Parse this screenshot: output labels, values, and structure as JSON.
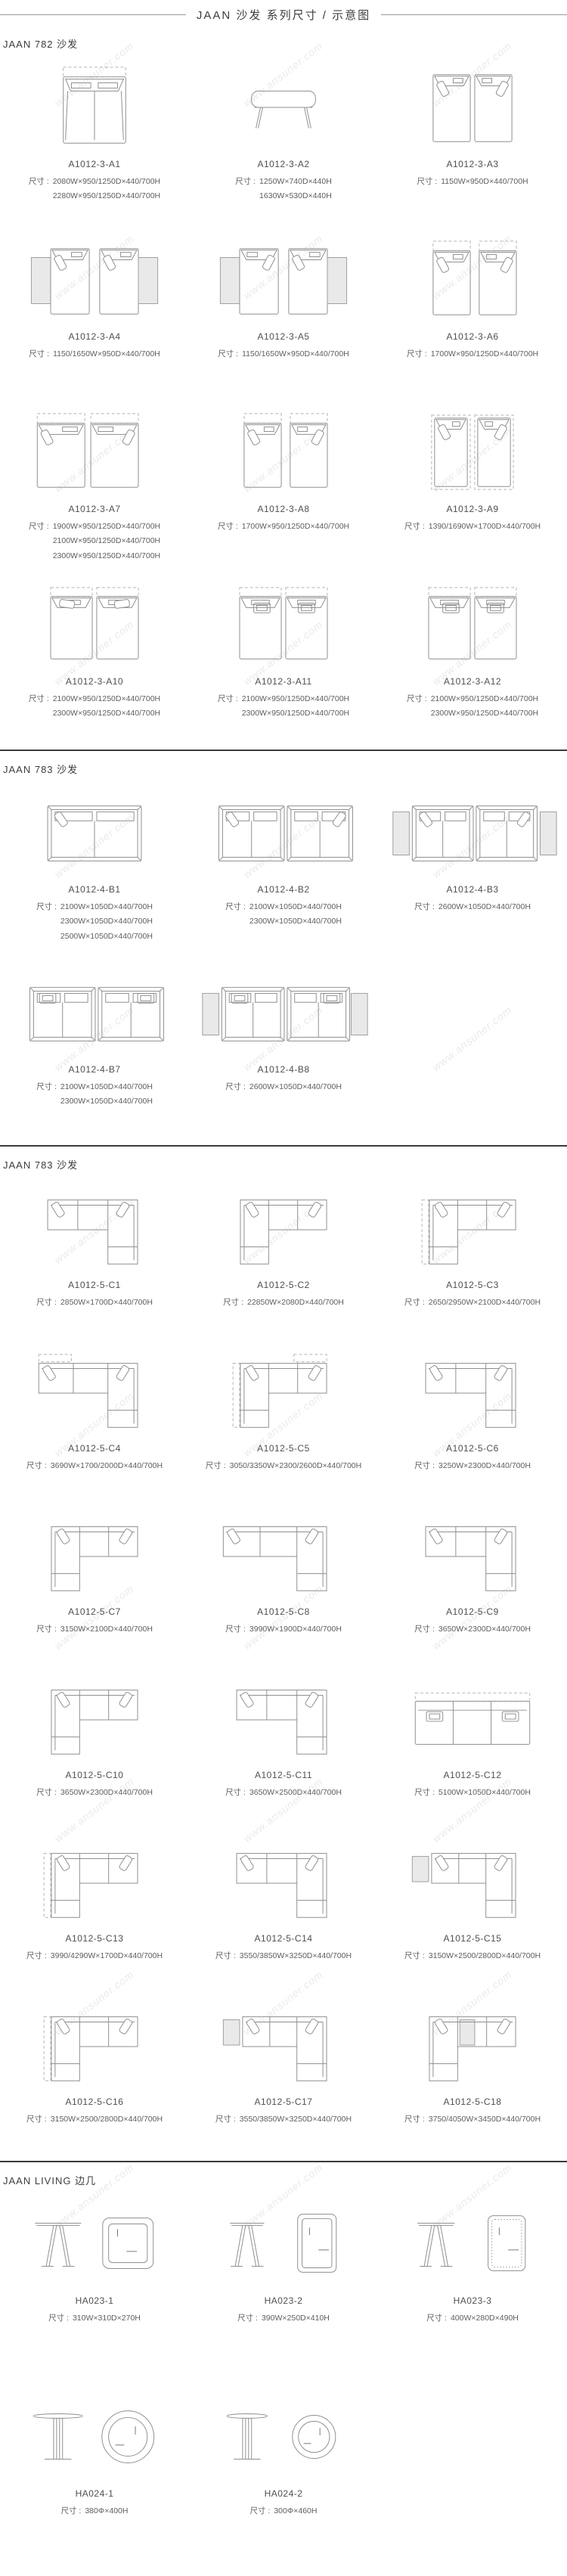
{
  "page": {
    "title": "JAAN  沙发 系列尺寸 / 示意图",
    "watermark": "www.ansuner.com",
    "dims_label": "尺寸 :"
  },
  "sections": [
    {
      "heading": "JAAN 782 沙发",
      "rows": [
        {
          "items": [
            {
              "model": "A1012-3-A1",
              "dims": [
                "2080W×950/1250D×440/700H",
                "2280W×950/1250D×440/700H"
              ],
              "drawing": "sofa-top-dashed"
            },
            {
              "model": "A1012-3-A2",
              "dims": [
                "1250W×740D×440H",
                "1630W×530D×440H"
              ],
              "drawing": "bench-side"
            },
            {
              "model": "A1012-3-A3",
              "dims": [
                "1150W×950D×440/700H"
              ],
              "drawing": "module-pair"
            }
          ]
        },
        {
          "items": [
            {
              "model": "A1012-3-A4",
              "dims": [
                "1150/1650W×950D×440/700H"
              ],
              "drawing": "module-pair-tables"
            },
            {
              "model": "A1012-3-A5",
              "dims": [
                "1150/1650W×950D×440/700H"
              ],
              "drawing": "module-pair-tables-in"
            },
            {
              "model": "A1012-3-A6",
              "dims": [
                "1700W×950/1250D×440/700H"
              ],
              "drawing": "module-pair-dash-top"
            }
          ]
        },
        {
          "items": [
            {
              "model": "A1012-3-A7",
              "dims": [
                "1900W×950/1250D×440/700H",
                "2100W×950/1250D×440/700H",
                "2300W×950/1250D×440/700H"
              ],
              "drawing": "module-pair-dash-top-wide"
            },
            {
              "model": "A1012-3-A8",
              "dims": [
                "1700W×950/1250D×440/700H"
              ],
              "drawing": "module-pair-dash-top"
            },
            {
              "model": "A1012-3-A9",
              "dims": [
                "1390/1690W×1700D×440/700H"
              ],
              "drawing": "module-pair-tall-dash"
            }
          ]
        },
        {
          "items": [
            {
              "model": "A1012-3-A10",
              "dims": [
                "2100W×950/1250D×440/700H",
                "2300W×950/1250D×440/700H"
              ],
              "drawing": "module-pair-dash-recline"
            },
            {
              "model": "A1012-3-A11",
              "dims": [
                "2100W×950/1250D×440/700H",
                "2300W×950/1250D×440/700H"
              ],
              "drawing": "module-pair-dash-tray"
            },
            {
              "model": "A1012-3-A12",
              "dims": [
                "2100W×950/1250D×440/700H",
                "2300W×950/1250D×440/700H"
              ],
              "drawing": "module-pair-dash-tray"
            }
          ]
        }
      ]
    },
    {
      "heading": "JAAN 783 沙发",
      "rows": [
        {
          "items": [
            {
              "model": "A1012-4-B1",
              "dims": [
                "2100W×1050D×440/700H",
                "2300W×1050D×440/700H",
                "2500W×1050D×440/700H"
              ],
              "drawing": "sofa-wide"
            },
            {
              "model": "A1012-4-B2",
              "dims": [
                "2100W×1050D×440/700H",
                "2300W×1050D×440/700H"
              ],
              "drawing": "sofa-wide-pair"
            },
            {
              "model": "A1012-4-B3",
              "dims": [
                "2600W×1050D×440/700H"
              ],
              "drawing": "sofa-wide-pair-tables"
            }
          ]
        },
        {
          "items": [
            {
              "model": "A1012-4-B7",
              "dims": [
                "2100W×1050D×440/700H",
                "2300W×1050D×440/700H"
              ],
              "drawing": "sofa-tray-pair"
            },
            {
              "model": "A1012-4-B8",
              "dims": [
                "2600W×1050D×440/700H"
              ],
              "drawing": "sofa-tray-pair-tables"
            }
          ]
        }
      ]
    },
    {
      "heading": "JAAN 783 沙发",
      "rows": [
        {
          "items": [
            {
              "model": "A1012-5-C1",
              "dims": [
                "2850W×1700D×440/700H"
              ],
              "drawing": "l-tr"
            },
            {
              "model": "A1012-5-C2",
              "dims": [
                "22850W×2080D×440/700H"
              ],
              "drawing": "l-tl"
            },
            {
              "model": "A1012-5-C3",
              "dims": [
                "2650/2950W×2100D×440/700H"
              ],
              "drawing": "l-tl-dash"
            }
          ]
        },
        {
          "items": [
            {
              "model": "A1012-5-C4",
              "dims": [
                "3690W×1700/2000D×440/700H"
              ],
              "drawing": "l-tr-dash"
            },
            {
              "model": "A1012-5-C5",
              "dims": [
                "3050/3350W×2300/2600D×440/700H"
              ],
              "drawing": "l-tl-dash2"
            },
            {
              "model": "A1012-5-C6",
              "dims": [
                "3250W×2300D×440/700H"
              ],
              "drawing": "l-tr"
            }
          ]
        },
        {
          "items": [
            {
              "model": "A1012-5-C7",
              "dims": [
                "3150W×2100D×440/700H"
              ],
              "drawing": "l-tl"
            },
            {
              "model": "A1012-5-C8",
              "dims": [
                "3990W×1900D×440/700H"
              ],
              "drawing": "l-tr-wide"
            },
            {
              "model": "A1012-5-C9",
              "dims": [
                "3650W×2300D×440/700H"
              ],
              "drawing": "l-tr"
            }
          ]
        },
        {
          "items": [
            {
              "model": "A1012-5-C10",
              "dims": [
                "3650W×2300D×440/700H"
              ],
              "drawing": "l-tl"
            },
            {
              "model": "A1012-5-C11",
              "dims": [
                "3650W×2500D×440/700H"
              ],
              "drawing": "l-tr"
            },
            {
              "model": "A1012-5-C12",
              "dims": [
                "5100W×1050D×440/700H"
              ],
              "drawing": "straight-3"
            }
          ]
        },
        {
          "items": [
            {
              "model": "A1012-5-C13",
              "dims": [
                "3990/4290W×1700D×440/700H"
              ],
              "drawing": "l-tl-dash"
            },
            {
              "model": "A1012-5-C14",
              "dims": [
                "3550/3850W×3250D×440/700H"
              ],
              "drawing": "l-tr"
            },
            {
              "model": "A1012-5-C15",
              "dims": [
                "3150W×2500/2800D×440/700H"
              ],
              "drawing": "l-tr-table"
            }
          ]
        },
        {
          "items": [
            {
              "model": "A1012-5-C16",
              "dims": [
                "3150W×2500/2800D×440/700H"
              ],
              "drawing": "l-tl-dash"
            },
            {
              "model": "A1012-5-C17",
              "dims": [
                "3550/3850W×3250D×440/700H"
              ],
              "drawing": "l-tr-table"
            },
            {
              "model": "A1012-5-C18",
              "dims": [
                "3750/4050W×3450D×440/700H"
              ],
              "drawing": "l-tl-table"
            }
          ]
        }
      ]
    },
    {
      "heading": "JAAN LIVING 边几",
      "rows": [
        {
          "items": [
            {
              "model": "HA023-1",
              "dims": [
                "310W×310D×270H"
              ],
              "drawing": "side-table-square"
            },
            {
              "model": "HA023-2",
              "dims": [
                "390W×250D×410H"
              ],
              "drawing": "side-table-rect"
            },
            {
              "model": "HA023-3",
              "dims": [
                "400W×280D×490H"
              ],
              "drawing": "side-table-rect-dotted"
            }
          ]
        },
        {
          "items": [
            {
              "model": "HA024-1",
              "dims": [
                "380Φ×400H"
              ],
              "drawing": "side-table-round"
            },
            {
              "model": "HA024-2",
              "dims": [
                "300Φ×460H"
              ],
              "drawing": "side-table-round-small"
            }
          ]
        }
      ]
    }
  ]
}
